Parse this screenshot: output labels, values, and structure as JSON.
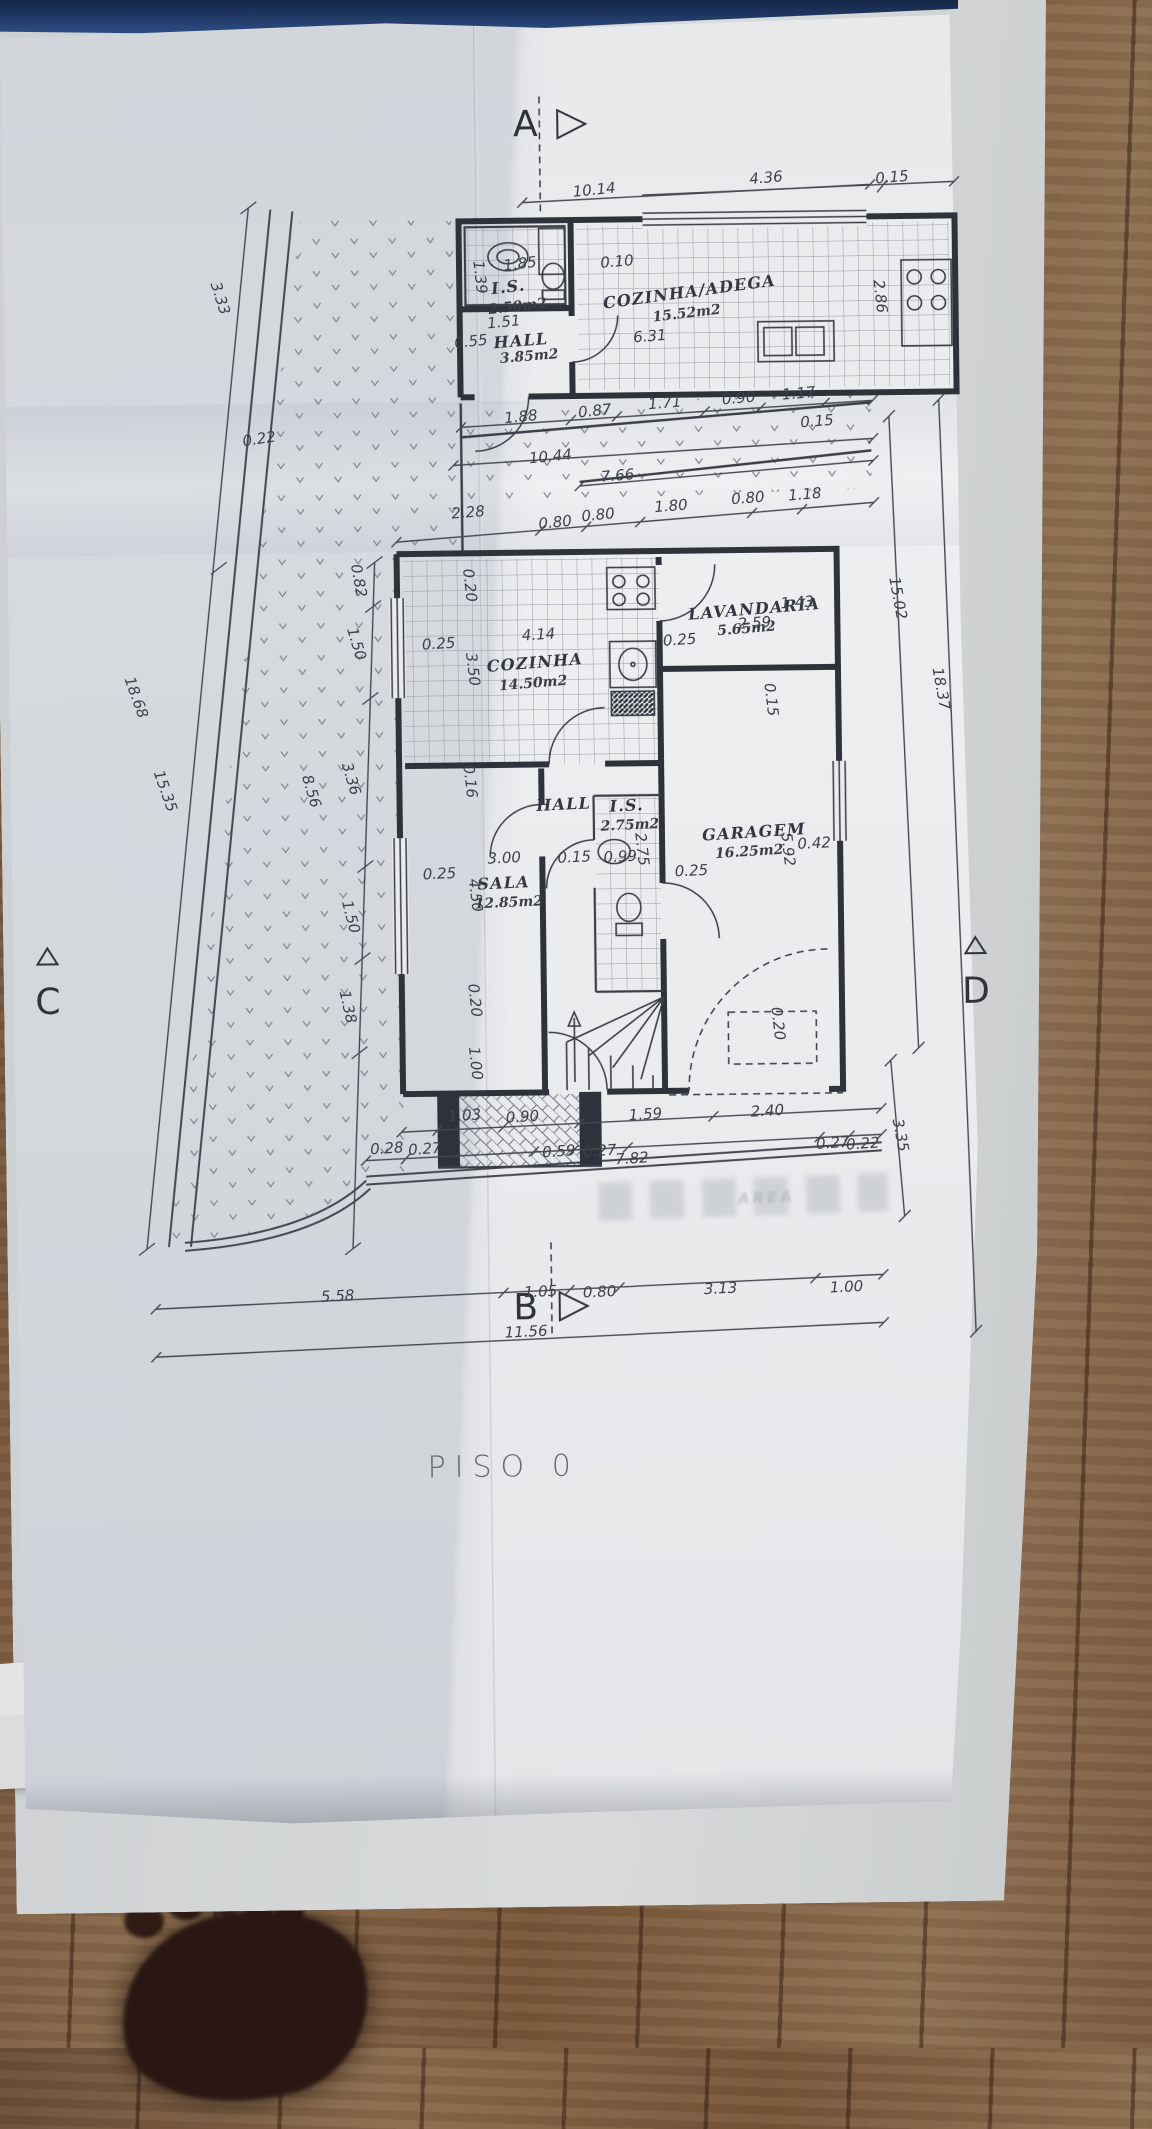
{
  "drawing": {
    "title": "PISO  0",
    "section_markers": [
      "A",
      "B",
      "C",
      "D"
    ],
    "rooms": [
      {
        "name": "I.S.",
        "area": "2.50m2"
      },
      {
        "name": "HALL",
        "area": "3.85m2"
      },
      {
        "name": "COZINHA/ADEGA",
        "area": "15.52m2"
      },
      {
        "name": "COZINHA",
        "area": "14.50m2"
      },
      {
        "name": "LAVANDARIA",
        "area": "5.65m2"
      },
      {
        "name": "HALL",
        "area": ""
      },
      {
        "name": "I.S.",
        "area": "2.75m2"
      },
      {
        "name": "SALA",
        "area": "12.85m2"
      },
      {
        "name": "GARAGEM",
        "area": "16.25m2"
      }
    ],
    "labels": [
      {
        "n": "marker-a",
        "t": "A",
        "x": 524,
        "y": 120,
        "r": 0,
        "c": "mk"
      },
      {
        "n": "marker-b",
        "t": "B",
        "x": 510,
        "y": 1303,
        "r": 0,
        "c": "mk"
      },
      {
        "n": "marker-c",
        "t": "C",
        "x": 36,
        "y": 992,
        "r": 0,
        "c": "mk"
      },
      {
        "n": "marker-d",
        "t": "D",
        "x": 964,
        "y": 992,
        "r": 0,
        "c": "mk"
      },
      {
        "n": "floor-title",
        "t": "PISO  0",
        "x": 486,
        "y": 1462,
        "r": 0,
        "c": "title"
      },
      {
        "n": "ghost-stamp",
        "t": "AREA",
        "x": 752,
        "y": 1196,
        "r": -2,
        "c": "ghost"
      },
      {
        "n": "dim-10-14",
        "t": "10.14",
        "x": 592,
        "y": 186,
        "r": -5,
        "c": "dim"
      },
      {
        "n": "dim-4-36",
        "t": "4.36",
        "x": 764,
        "y": 176,
        "r": -4,
        "c": "dim"
      },
      {
        "n": "dim-0-15-a",
        "t": "0.15",
        "x": 890,
        "y": 177,
        "r": -4,
        "c": "dim"
      },
      {
        "n": "dim-0-10",
        "t": "0.10",
        "x": 614,
        "y": 258,
        "r": -4,
        "c": "dim"
      },
      {
        "n": "dim-1-85",
        "t": "1.85",
        "x": 517,
        "y": 259,
        "r": -6,
        "c": "dim"
      },
      {
        "n": "dim-1-39",
        "t": "1.39",
        "x": 477,
        "y": 272,
        "r": 84,
        "c": "dimv"
      },
      {
        "n": "dim-1-51",
        "t": "1.51",
        "x": 500,
        "y": 317,
        "r": -5,
        "c": "dim"
      },
      {
        "n": "dim-0-55",
        "t": "0.55",
        "x": 467,
        "y": 336,
        "r": -5,
        "c": "dim"
      },
      {
        "n": "dim-6-31",
        "t": "6.31",
        "x": 646,
        "y": 333,
        "r": -4,
        "c": "dim"
      },
      {
        "n": "dim-2-86",
        "t": "2.86",
        "x": 877,
        "y": 296,
        "r": 84,
        "c": "dimv"
      },
      {
        "n": "room-is1",
        "t": "I.S.",
        "x": 505,
        "y": 282,
        "r": -6,
        "c": "rm"
      },
      {
        "n": "area-is1",
        "t": "2.50m2",
        "x": 514,
        "y": 302,
        "r": -6,
        "c": "ar"
      },
      {
        "n": "room-hall1",
        "t": "HALL",
        "x": 517,
        "y": 336,
        "r": -4,
        "c": "rm"
      },
      {
        "n": "area-hall1",
        "t": "3.85m2",
        "x": 525,
        "y": 352,
        "r": -4,
        "c": "ar"
      },
      {
        "n": "room-cozadega",
        "t": "COZINHA/ADEGA",
        "x": 686,
        "y": 289,
        "r": -7,
        "c": "rm"
      },
      {
        "n": "area-cozadega",
        "t": "15.52m2",
        "x": 683,
        "y": 311,
        "r": -6,
        "c": "ar"
      },
      {
        "n": "dim-1-88",
        "t": "1.88",
        "x": 516,
        "y": 412,
        "r": -5,
        "c": "dim"
      },
      {
        "n": "dim-0-87",
        "t": "0.87",
        "x": 590,
        "y": 407,
        "r": -5,
        "c": "dim"
      },
      {
        "n": "dim-1-71",
        "t": "1.71",
        "x": 660,
        "y": 400,
        "r": -4,
        "c": "dim"
      },
      {
        "n": "dim-0-90",
        "t": "0.90",
        "x": 734,
        "y": 396,
        "r": -4,
        "c": "dim"
      },
      {
        "n": "dim-1-17",
        "t": "1.17",
        "x": 794,
        "y": 392,
        "r": -4,
        "c": "dim"
      },
      {
        "n": "dim-0-15-b",
        "t": "0.15",
        "x": 812,
        "y": 420,
        "r": -4,
        "c": "dim"
      },
      {
        "n": "dim-10-44",
        "t": "10.44",
        "x": 545,
        "y": 452,
        "r": -5,
        "c": "dim"
      },
      {
        "n": "dim-7-66",
        "t": "7.66",
        "x": 612,
        "y": 472,
        "r": -4,
        "c": "dim"
      },
      {
        "n": "dim-2-28",
        "t": "2.28",
        "x": 462,
        "y": 507,
        "r": -4,
        "c": "dim"
      },
      {
        "n": "dim-0-80-a",
        "t": "0.80",
        "x": 549,
        "y": 518,
        "r": -5,
        "c": "dim"
      },
      {
        "n": "dim-0-80-b",
        "t": "0.80",
        "x": 592,
        "y": 511,
        "r": -5,
        "c": "dim"
      },
      {
        "n": "dim-1-80",
        "t": "1.80",
        "x": 665,
        "y": 503,
        "r": -4,
        "c": "dim"
      },
      {
        "n": "dim-0-80-c",
        "t": "0.80",
        "x": 742,
        "y": 496,
        "r": -4,
        "c": "dim"
      },
      {
        "n": "dim-1-18",
        "t": "1.18",
        "x": 799,
        "y": 493,
        "r": -4,
        "c": "dim"
      },
      {
        "n": "dim-3-33",
        "t": "3.33",
        "x": 217,
        "y": 290,
        "r": 73,
        "c": "dimv"
      },
      {
        "n": "dim-0-22",
        "t": "0.22",
        "x": 254,
        "y": 431,
        "r": -8,
        "c": "dim"
      },
      {
        "n": "dim-18-68",
        "t": "18.68",
        "x": 128,
        "y": 688,
        "r": 71,
        "c": "dimv"
      },
      {
        "n": "dim-15-35",
        "t": "15.35",
        "x": 156,
        "y": 782,
        "r": 71,
        "c": "dimv"
      },
      {
        "n": "dim-8-56",
        "t": "8.56",
        "x": 302,
        "y": 784,
        "r": 74,
        "c": "dimv"
      },
      {
        "n": "dim-3-36",
        "t": "3.36",
        "x": 342,
        "y": 772,
        "r": 74,
        "c": "dimv"
      },
      {
        "n": "dim-1-50-a",
        "t": "1.50",
        "x": 349,
        "y": 637,
        "r": 74,
        "c": "dimv"
      },
      {
        "n": "dim-0-82",
        "t": "0.82",
        "x": 352,
        "y": 574,
        "r": 80,
        "c": "dimv"
      },
      {
        "n": "dim-1-50-b",
        "t": "1.50",
        "x": 340,
        "y": 910,
        "r": 76,
        "c": "dimv"
      },
      {
        "n": "dim-1-38",
        "t": "1.38",
        "x": 336,
        "y": 1000,
        "r": 78,
        "c": "dimv"
      },
      {
        "n": "dim-0-20-a",
        "t": "0.20",
        "x": 463,
        "y": 580,
        "r": 84,
        "c": "dimv"
      },
      {
        "n": "dim-0-25-a",
        "t": "0.25",
        "x": 431,
        "y": 638,
        "r": -3,
        "c": "dim"
      },
      {
        "n": "dim-4-14",
        "t": "4.14",
        "x": 531,
        "y": 630,
        "r": -3,
        "c": "dim"
      },
      {
        "n": "dim-3-50",
        "t": "3.50",
        "x": 465,
        "y": 664,
        "r": 84,
        "c": "dimv"
      },
      {
        "n": "room-cozinha",
        "t": "COZINHA",
        "x": 527,
        "y": 658,
        "r": -4,
        "c": "rm"
      },
      {
        "n": "area-cozinha",
        "t": "14.50m2",
        "x": 525,
        "y": 679,
        "r": -4,
        "c": "ar"
      },
      {
        "n": "dim-0-25-b",
        "t": "0.25",
        "x": 672,
        "y": 637,
        "r": -3,
        "c": "dim"
      },
      {
        "n": "room-lavandaria",
        "t": "LAVANDARIA",
        "x": 747,
        "y": 607,
        "r": -4,
        "c": "rm"
      },
      {
        "n": "area-lavandaria",
        "t": "5.65m2",
        "x": 739,
        "y": 627,
        "r": -4,
        "c": "ar"
      },
      {
        "n": "dim-2-59",
        "t": "2.59",
        "x": 747,
        "y": 621,
        "r": -3,
        "c": "dim"
      },
      {
        "n": "dim-1-43",
        "t": "1.43",
        "x": 790,
        "y": 601,
        "r": -3,
        "c": "dim"
      },
      {
        "n": "dim-15-02",
        "t": "15.02",
        "x": 891,
        "y": 598,
        "r": 80,
        "c": "dimv"
      },
      {
        "n": "dim-18-37",
        "t": "18.37",
        "x": 933,
        "y": 689,
        "r": 80,
        "c": "dimv"
      },
      {
        "n": "dim-0-15-c",
        "t": "0.15",
        "x": 763,
        "y": 698,
        "r": 84,
        "c": "dimv"
      },
      {
        "n": "dim-0-16",
        "t": "0.16",
        "x": 461,
        "y": 776,
        "r": 84,
        "c": "dimv"
      },
      {
        "n": "room-hall2",
        "t": "HALL",
        "x": 554,
        "y": 800,
        "r": -2,
        "c": "rm"
      },
      {
        "n": "room-is2",
        "t": "I.S.",
        "x": 617,
        "y": 802,
        "r": -2,
        "c": "rm"
      },
      {
        "n": "area-is2",
        "t": "2.75m2",
        "x": 620,
        "y": 822,
        "r": -2,
        "c": "ar"
      },
      {
        "n": "dim-2-75",
        "t": "2.75",
        "x": 632,
        "y": 846,
        "r": 84,
        "c": "dimv"
      },
      {
        "n": "dim-0-15-d",
        "t": "0.15",
        "x": 564,
        "y": 853,
        "r": -2,
        "c": "dim"
      },
      {
        "n": "dim-0-99",
        "t": "0.99",
        "x": 610,
        "y": 853,
        "r": -2,
        "c": "dim"
      },
      {
        "n": "dim-0-25-c",
        "t": "0.25",
        "x": 681,
        "y": 868,
        "r": -2,
        "c": "dim"
      },
      {
        "n": "room-garagem",
        "t": "GARAGEM",
        "x": 744,
        "y": 830,
        "r": -3,
        "c": "rm"
      },
      {
        "n": "area-garagem",
        "t": "16.25m2",
        "x": 739,
        "y": 850,
        "r": -3,
        "c": "ar"
      },
      {
        "n": "dim-5-92",
        "t": "5.92",
        "x": 778,
        "y": 848,
        "r": 84,
        "c": "dimv"
      },
      {
        "n": "dim-0-42",
        "t": "0.42",
        "x": 804,
        "y": 842,
        "r": -2,
        "c": "dim"
      },
      {
        "n": "room-sala",
        "t": "SALA",
        "x": 493,
        "y": 878,
        "r": -2,
        "c": "rm"
      },
      {
        "n": "area-sala",
        "t": "12.85m2",
        "x": 498,
        "y": 898,
        "r": -2,
        "c": "ar"
      },
      {
        "n": "dim-4-50",
        "t": "4.50",
        "x": 465,
        "y": 890,
        "r": 84,
        "c": "dimv"
      },
      {
        "n": "dim-3-00",
        "t": "3.00",
        "x": 494,
        "y": 853,
        "r": -2,
        "c": "dim"
      },
      {
        "n": "dim-0-25-d",
        "t": "0.25",
        "x": 429,
        "y": 868,
        "r": -2,
        "c": "dim"
      },
      {
        "n": "dim-0-20-b",
        "t": "0.20",
        "x": 463,
        "y": 995,
        "r": 84,
        "c": "dimv"
      },
      {
        "n": "dim-1-00-a",
        "t": "1.00",
        "x": 463,
        "y": 1058,
        "r": 84,
        "c": "dimv"
      },
      {
        "n": "dim-0-20-c",
        "t": "0.20",
        "x": 766,
        "y": 1022,
        "r": 84,
        "c": "dimv"
      },
      {
        "n": "dim-1-03",
        "t": "1.03",
        "x": 451,
        "y": 1110,
        "r": -3,
        "c": "dim"
      },
      {
        "n": "dim-0-90-b",
        "t": "0.90",
        "x": 509,
        "y": 1112,
        "r": -3,
        "c": "dim"
      },
      {
        "n": "dim-1-59",
        "t": "1.59",
        "x": 632,
        "y": 1111,
        "r": -3,
        "c": "dim"
      },
      {
        "n": "dim-2-40",
        "t": "2.40",
        "x": 754,
        "y": 1109,
        "r": -3,
        "c": "dim"
      },
      {
        "n": "dim-0-28",
        "t": "0.28",
        "x": 373,
        "y": 1142,
        "r": -3,
        "c": "dim"
      },
      {
        "n": "dim-0-27-a",
        "t": "0.27",
        "x": 411,
        "y": 1143,
        "r": -3,
        "c": "dim"
      },
      {
        "n": "dim-0-59",
        "t": "0.59",
        "x": 545,
        "y": 1147,
        "r": -3,
        "c": "dim"
      },
      {
        "n": "dim-0-27-b",
        "t": "0.27",
        "x": 586,
        "y": 1147,
        "r": -3,
        "c": "dim"
      },
      {
        "n": "dim-7-82",
        "t": "7.82",
        "x": 618,
        "y": 1155,
        "r": -3,
        "c": "dim"
      },
      {
        "n": "dim-0-27-c",
        "t": "0.27",
        "x": 819,
        "y": 1142,
        "r": -3,
        "c": "dim"
      },
      {
        "n": "dim-0-22-b",
        "t": "0.22",
        "x": 849,
        "y": 1143,
        "r": -3,
        "c": "dim"
      },
      {
        "n": "dim-3-35",
        "t": "3.35",
        "x": 887,
        "y": 1135,
        "r": 80,
        "c": "dimv"
      },
      {
        "n": "dim-5-58",
        "t": "5.58",
        "x": 322,
        "y": 1289,
        "r": -2,
        "c": "dim"
      },
      {
        "n": "dim-1-05",
        "t": "1.05",
        "x": 525,
        "y": 1287,
        "r": -2,
        "c": "dim"
      },
      {
        "n": "dim-0-80-d",
        "t": "0.80",
        "x": 584,
        "y": 1288,
        "r": -2,
        "c": "dim"
      },
      {
        "n": "dim-3-13",
        "t": "3.13",
        "x": 705,
        "y": 1286,
        "r": -2,
        "c": "dim"
      },
      {
        "n": "dim-1-00-b",
        "t": "1.00",
        "x": 831,
        "y": 1286,
        "r": -2,
        "c": "dim"
      },
      {
        "n": "dim-11-56",
        "t": "11.56",
        "x": 510,
        "y": 1327,
        "r": -2,
        "c": "dim"
      }
    ]
  }
}
